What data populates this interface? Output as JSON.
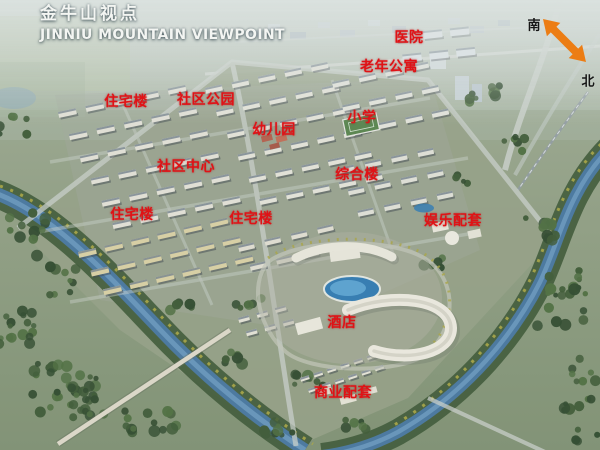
{
  "title": {
    "cn": "金牛山视点",
    "en": "JINNIU MOUNTAIN VIEWPOINT"
  },
  "compass": {
    "south_label": "南",
    "north_label": "北"
  },
  "labels": [
    {
      "id": "hospital",
      "text": "医院",
      "x": 409,
      "y": 37
    },
    {
      "id": "senior-apartments",
      "text": "老年公寓",
      "x": 389,
      "y": 66
    },
    {
      "id": "residential-north",
      "text": "住宅楼",
      "x": 126,
      "y": 101
    },
    {
      "id": "community-park",
      "text": "社区公园",
      "x": 206,
      "y": 99
    },
    {
      "id": "kindergarten",
      "text": "幼儿园",
      "x": 274,
      "y": 129
    },
    {
      "id": "primary-school",
      "text": "小学",
      "x": 362,
      "y": 117
    },
    {
      "id": "community-center",
      "text": "社区中心",
      "x": 186,
      "y": 166
    },
    {
      "id": "mixed-use-building",
      "text": "综合楼",
      "x": 357,
      "y": 174
    },
    {
      "id": "residential-west",
      "text": "住宅楼",
      "x": 132,
      "y": 214
    },
    {
      "id": "residential-mid",
      "text": "住宅楼",
      "x": 251,
      "y": 218
    },
    {
      "id": "entertainment-facilities",
      "text": "娱乐配套",
      "x": 453,
      "y": 220
    },
    {
      "id": "hotel",
      "text": "酒店",
      "x": 342,
      "y": 322
    },
    {
      "id": "commercial-facilities",
      "text": "商业配套",
      "x": 343,
      "y": 392
    }
  ],
  "colors": {
    "label_red": "#e01216",
    "compass_orange": "#ec7d14",
    "title_white": "#f3f5f2"
  }
}
